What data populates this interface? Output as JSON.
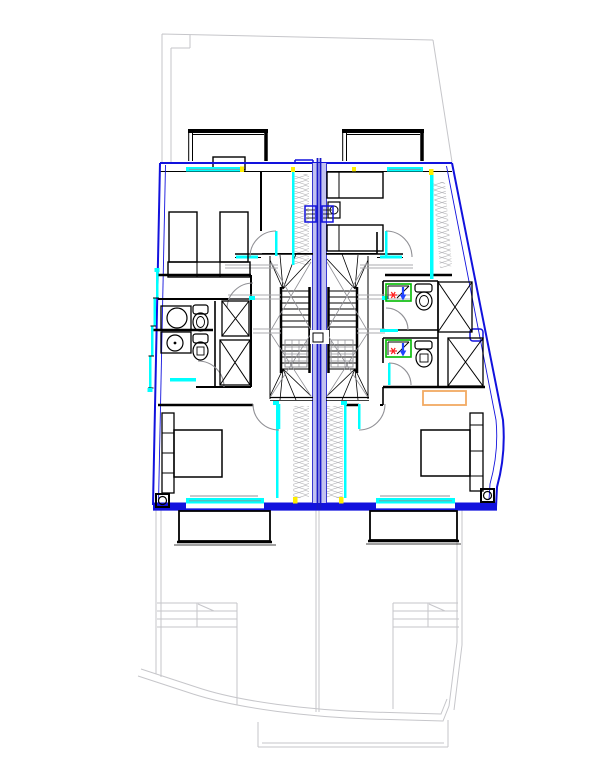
{
  "meta": {
    "title": "Upper floor plan — semi-detached house with two mirrored units",
    "drawing_type": "architectural-floor-plan",
    "visible_text": "none"
  },
  "colors": {
    "outline_blue": "#1212dd",
    "party_wall_fill": "#c2c2f0",
    "party_wall_line": "#1717c8",
    "window_cyan": "#00ffff",
    "site_gray": "#c6c6ca",
    "detail_gray": "#909095",
    "wall_black": "#000000",
    "insulation_gray": "#b4b4b8",
    "shower_green": "#00bb00",
    "hot_red": "#ff2020",
    "cold_blue": "#2244ff",
    "wardrobe_orange": "#f2aa62",
    "marker_yellow": "#ffee00"
  },
  "elements": {
    "units": [
      "left-unit",
      "right-unit"
    ],
    "rooms": [
      "bedroom-top-left",
      "bedroom-top-right",
      "bedroom-bottom-left",
      "bedroom-bottom-right",
      "bathroom-left-upper",
      "bathroom-left-lower",
      "bathroom-right-upper",
      "bathroom-right-lower",
      "stair-hall-left",
      "stair-hall-right"
    ],
    "fixtures": {
      "single_beds": 4,
      "double_beds": 2,
      "wash_basins": 2,
      "toilets": 4,
      "shower_trays": 2,
      "stairs": 2,
      "balconies": 2,
      "roof_terraces": 2,
      "service_shafts": 4,
      "wardrobe": 1,
      "columns": 2,
      "wall_radiators": 2,
      "door_swings": 8
    },
    "symbols": [
      "insulation-hatch",
      "balcony-grid-hatch",
      "hot-cold-water-symbol",
      "site-boundary",
      "ground-floor-outline"
    ]
  }
}
